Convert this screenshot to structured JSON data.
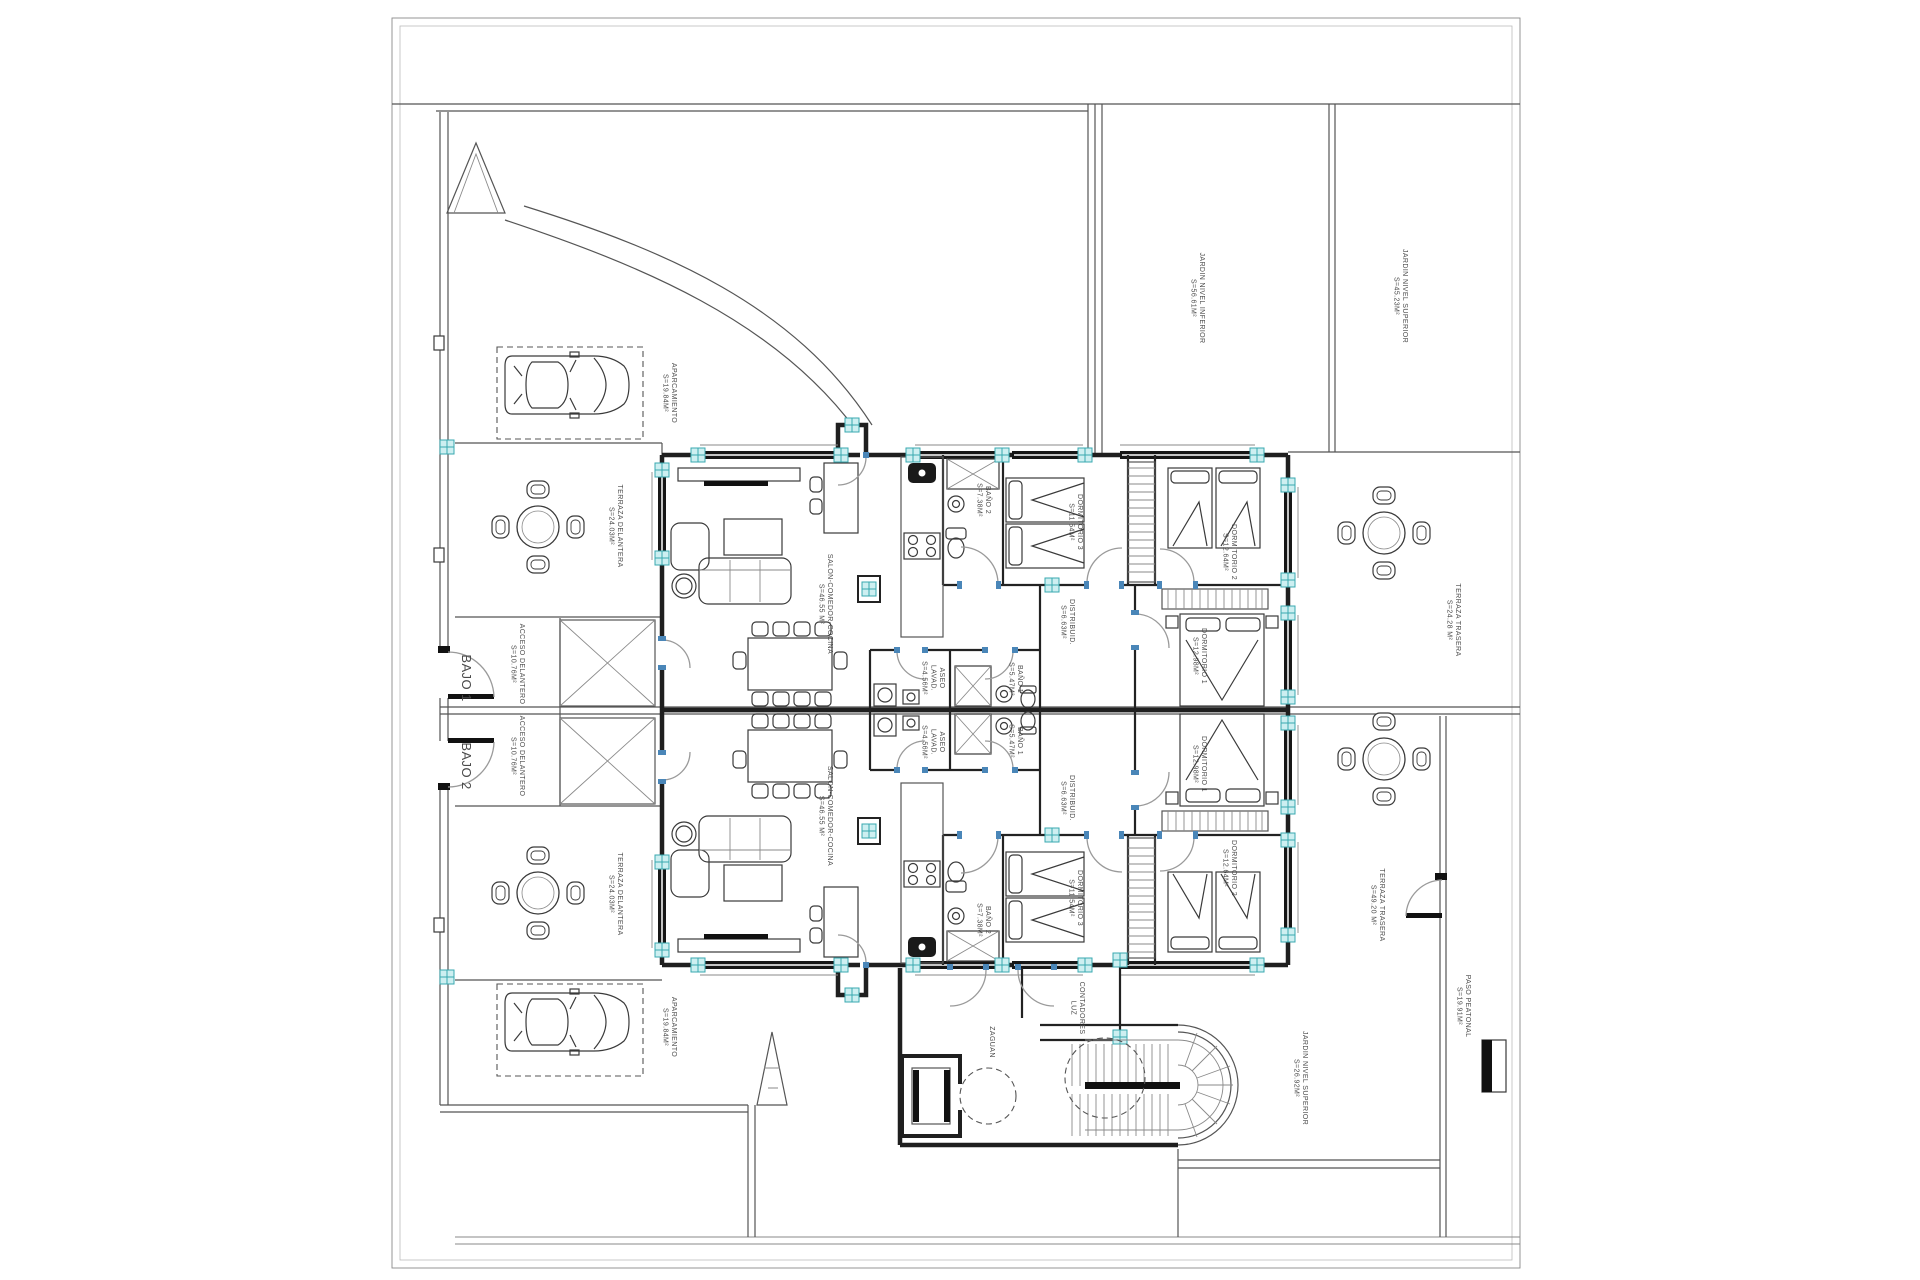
{
  "plan": {
    "type": "architectural-floor-plan",
    "units": [
      {
        "id": "bajo-1",
        "label": "BAJO 1"
      },
      {
        "id": "bajo-2",
        "label": "BAJO 2"
      }
    ],
    "colors": {
      "wall": "#1f1f1f",
      "line": "#555555",
      "glazing": "#161616",
      "marker_fill": "#cdeff1",
      "marker_stroke": "#39a8b0",
      "door_jamb_blue": "#4a86b8",
      "label_text": "#4a4a4a",
      "background": "#ffffff"
    },
    "labels": [
      {
        "id": "bajo-1",
        "lines": [
          "BAJO 1"
        ],
        "x": 462,
        "y": 678,
        "size": 13
      },
      {
        "id": "bajo-2",
        "lines": [
          "BAJO 2"
        ],
        "x": 462,
        "y": 766,
        "size": 13
      },
      {
        "id": "aparcamiento-top",
        "lines": [
          "APARCAMIENTO",
          "S=19.84M²"
        ],
        "x": 672,
        "y": 393
      },
      {
        "id": "terraza-delantera-top",
        "lines": [
          "TERRAZA DELANTERA",
          "S=24.03M²"
        ],
        "x": 618,
        "y": 526
      },
      {
        "id": "acceso-delantero-top",
        "lines": [
          "ACCESO DELANTERO",
          "S=10.76M²"
        ],
        "x": 520,
        "y": 664
      },
      {
        "id": "acceso-delantero-bottom",
        "lines": [
          "ACCESO DELANTERO",
          "S=10.76M²"
        ],
        "x": 520,
        "y": 756
      },
      {
        "id": "terraza-delantera-bottom",
        "lines": [
          "TERRAZA DELANTERA",
          "S=24.03M²"
        ],
        "x": 618,
        "y": 894
      },
      {
        "id": "aparcamiento-bottom",
        "lines": [
          "APARCAMIENTO",
          "S=19.84M²"
        ],
        "x": 672,
        "y": 1027
      },
      {
        "id": "salon-comedor-top",
        "lines": [
          "SALON-COMEDOR-COCINA",
          "S=46.55 M²"
        ],
        "x": 828,
        "y": 604
      },
      {
        "id": "salon-comedor-bottom",
        "lines": [
          "SALON-COMEDOR-COCINA",
          "S=46.55 M²"
        ],
        "x": 828,
        "y": 816
      },
      {
        "id": "bano2-top",
        "lines": [
          "BAÑO 2",
          "S=7.38M²"
        ],
        "x": 986,
        "y": 500
      },
      {
        "id": "bano2-bottom",
        "lines": [
          "BAÑO 2",
          "S=7.38M²"
        ],
        "x": 986,
        "y": 920
      },
      {
        "id": "dormitorio3-top",
        "lines": [
          "DORMITORIO 3",
          "S=11.54M²"
        ],
        "x": 1078,
        "y": 522
      },
      {
        "id": "dormitorio3-bottom",
        "lines": [
          "DORMITORIO 3",
          "S=11.54M²"
        ],
        "x": 1078,
        "y": 898
      },
      {
        "id": "dormitorio2-top",
        "lines": [
          "DORMITORIO 2",
          "S=12.64M²"
        ],
        "x": 1232,
        "y": 552
      },
      {
        "id": "dormitorio2-bottom",
        "lines": [
          "DORMITORIO 2",
          "S=12.64M²"
        ],
        "x": 1232,
        "y": 868
      },
      {
        "id": "distribuidor-top",
        "lines": [
          "DISTRIBUID.",
          "S=6.63M²"
        ],
        "x": 1070,
        "y": 622
      },
      {
        "id": "distribuidor-bottom",
        "lines": [
          "DISTRIBUID.",
          "S=6.63M²"
        ],
        "x": 1070,
        "y": 798
      },
      {
        "id": "bano1-top",
        "lines": [
          "BAÑO 1",
          "S=5.47M²"
        ],
        "x": 1018,
        "y": 679
      },
      {
        "id": "bano1-bottom",
        "lines": [
          "BAÑO 1",
          "S=5.47M²"
        ],
        "x": 1018,
        "y": 741
      },
      {
        "id": "aseo-lavadero-top",
        "lines": [
          "ASEO",
          "LAVAD.",
          "S=4.56M²"
        ],
        "x": 940,
        "y": 678
      },
      {
        "id": "aseo-lavadero-bottom",
        "lines": [
          "ASEO",
          "LAVAD.",
          "S=4.56M²"
        ],
        "x": 940,
        "y": 742
      },
      {
        "id": "dormitorio1-top",
        "lines": [
          "DORMITORIO 1",
          "S=12.98M²"
        ],
        "x": 1202,
        "y": 656
      },
      {
        "id": "dormitorio1-bottom",
        "lines": [
          "DORMITORIO 1",
          "S=12.98M²"
        ],
        "x": 1202,
        "y": 764
      },
      {
        "id": "jardin-nivel-inferior",
        "lines": [
          "JARDIN NIVEL INFERIOR",
          "S=56.61M²"
        ],
        "x": 1200,
        "y": 298
      },
      {
        "id": "jardin-nivel-superior-top",
        "lines": [
          "JARDIN NIVEL SUPERIOR",
          "S=45.23M²"
        ],
        "x": 1403,
        "y": 296
      },
      {
        "id": "terraza-trasera-top",
        "lines": [
          "TERRAZA TRASERA",
          "S=24.28 M²"
        ],
        "x": 1456,
        "y": 620
      },
      {
        "id": "terraza-trasera-bottom",
        "lines": [
          "TERRAZA TRASERA",
          "S=49.20 M²"
        ],
        "x": 1380,
        "y": 905
      },
      {
        "id": "paso-peatonal",
        "lines": [
          "PASO PEATONAL",
          "S=19.91M²"
        ],
        "x": 1466,
        "y": 1006
      },
      {
        "id": "jardin-nivel-superior-bottom",
        "lines": [
          "JARDIN NIVEL SUPERIOR",
          "S=26.92M²"
        ],
        "x": 1303,
        "y": 1078
      },
      {
        "id": "zaguan",
        "lines": [
          "ZAGUAN"
        ],
        "x": 990,
        "y": 1042
      },
      {
        "id": "contadores-luz",
        "lines": [
          "CONTADORES",
          "LUZ"
        ],
        "x": 1080,
        "y": 1008
      }
    ]
  }
}
